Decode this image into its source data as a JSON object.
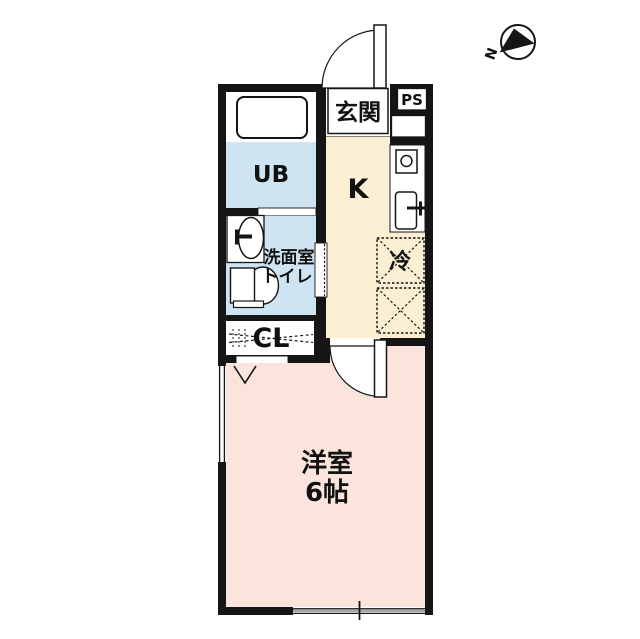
{
  "compass": {
    "north_label": "N"
  },
  "colors": {
    "wall": "#151515",
    "wet_area": "#cfe4f2",
    "kitchen_floor": "#faefd3",
    "room_floor": "#fbe4dc",
    "white": "#ffffff"
  },
  "rooms": {
    "genkan": {
      "label": "玄関"
    },
    "ps": {
      "label": "PS"
    },
    "kitchen": {
      "label": "K"
    },
    "unit_bath": {
      "label": "UB"
    },
    "washroom": {
      "line1": "洗面室",
      "line2": "トイレ"
    },
    "refrigerator": {
      "label": "冷"
    },
    "closet": {
      "label": "CL"
    },
    "western_room": {
      "line1": "洋室",
      "line2": "6帖"
    }
  }
}
